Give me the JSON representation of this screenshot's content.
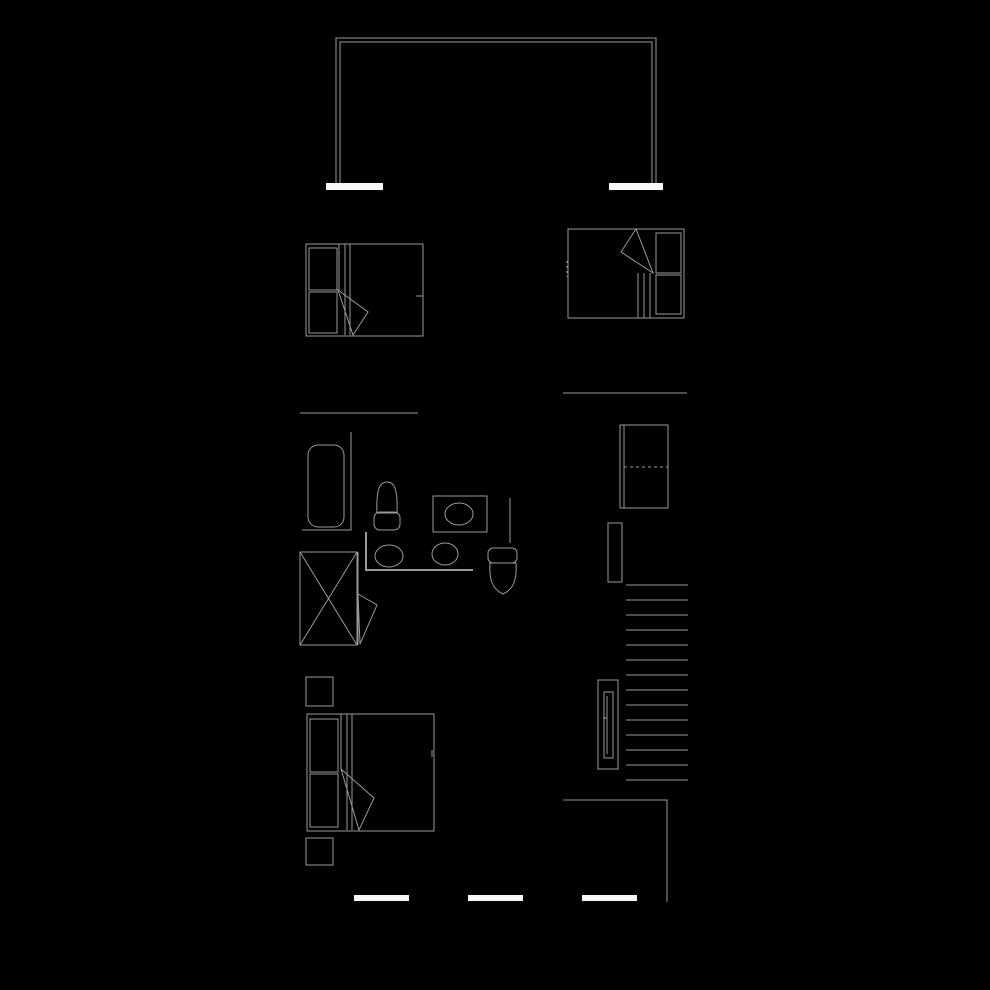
{
  "canvas": {
    "width": 990,
    "height": 990,
    "background": "#000000",
    "line_color": "#9a9a9a",
    "wall_fill": "#f7f7f7"
  },
  "floorplan": {
    "elements": [
      {
        "name": "balcony-rail-outer",
        "type": "polyline",
        "points": [
          [
            336,
            183
          ],
          [
            336,
            38
          ],
          [
            656,
            38
          ],
          [
            656,
            183
          ]
        ]
      },
      {
        "name": "balcony-rail-inner",
        "type": "polyline",
        "points": [
          [
            340,
            183
          ],
          [
            340,
            42
          ],
          [
            652,
            42
          ],
          [
            652,
            183
          ]
        ]
      },
      {
        "name": "balcony-sill-left",
        "type": "filled-rect",
        "x": 326,
        "y": 183,
        "w": 57,
        "h": 7
      },
      {
        "name": "balcony-sill-right",
        "type": "filled-rect",
        "x": 609,
        "y": 183,
        "w": 54,
        "h": 7
      },
      {
        "name": "bedroom1-bed-frame",
        "type": "rect",
        "x": 306,
        "y": 244,
        "w": 117,
        "h": 92
      },
      {
        "name": "bedroom1-pillow-1",
        "type": "rect",
        "x": 309,
        "y": 248,
        "w": 28,
        "h": 42
      },
      {
        "name": "bedroom1-pillow-2",
        "type": "rect",
        "x": 309,
        "y": 292,
        "w": 28,
        "h": 41
      },
      {
        "name": "bedroom1-sheet-line-1",
        "type": "line",
        "x1": 339,
        "y1": 244,
        "x2": 339,
        "y2": 290
      },
      {
        "name": "bedroom1-sheet-line-2",
        "type": "line",
        "x1": 345,
        "y1": 244,
        "x2": 345,
        "y2": 335
      },
      {
        "name": "bedroom1-sheet-line-3",
        "type": "line",
        "x1": 350,
        "y1": 244,
        "x2": 350,
        "y2": 335
      },
      {
        "name": "bedroom1-blanket-fold",
        "type": "polygon",
        "points": [
          [
            338,
            290
          ],
          [
            353,
            335
          ],
          [
            368,
            312
          ]
        ]
      },
      {
        "name": "bedroom1-edge-tick",
        "type": "line",
        "x1": 416,
        "y1": 296,
        "x2": 423,
        "y2": 296
      },
      {
        "name": "bedroom2-bed-frame",
        "type": "rect",
        "x": 568,
        "y": 229,
        "w": 116,
        "h": 89
      },
      {
        "name": "bedroom2-pillow-1",
        "type": "rect",
        "x": 656,
        "y": 233,
        "w": 25,
        "h": 40
      },
      {
        "name": "bedroom2-pillow-2",
        "type": "rect",
        "x": 656,
        "y": 275,
        "w": 25,
        "h": 39
      },
      {
        "name": "bedroom2-sheet-line-1",
        "type": "line",
        "x1": 638,
        "y1": 273,
        "x2": 638,
        "y2": 318
      },
      {
        "name": "bedroom2-sheet-line-2",
        "type": "line",
        "x1": 644,
        "y1": 273,
        "x2": 644,
        "y2": 318
      },
      {
        "name": "bedroom2-sheet-line-3",
        "type": "line",
        "x1": 650,
        "y1": 273,
        "x2": 650,
        "y2": 318
      },
      {
        "name": "bedroom2-blanket-fold",
        "type": "polygon",
        "points": [
          [
            636,
            229
          ],
          [
            621,
            252
          ],
          [
            653,
            273
          ]
        ]
      },
      {
        "name": "bedroom2-edge-tick",
        "type": "dashed-line",
        "x1": 567,
        "y1": 261,
        "x2": 567,
        "y2": 277,
        "dash": "2 3"
      },
      {
        "name": "partition-wall-left",
        "type": "line",
        "x1": 300,
        "y1": 413,
        "x2": 418,
        "y2": 413
      },
      {
        "name": "partition-wall-right",
        "type": "line",
        "x1": 563,
        "y1": 393,
        "x2": 687,
        "y2": 393
      },
      {
        "name": "bathtub",
        "type": "rounded-rect",
        "x": 308,
        "y": 445,
        "w": 36,
        "h": 82,
        "r": 10
      },
      {
        "name": "bathtub-wall",
        "type": "polyline",
        "points": [
          [
            351,
            432
          ],
          [
            351,
            530
          ],
          [
            302,
            530
          ]
        ]
      },
      {
        "name": "bidet-bowl",
        "type": "path",
        "d": "M377,513 C376,488 380,482 387,482 C394,482 398,488 397,513"
      },
      {
        "name": "bidet-base",
        "type": "rounded-rect",
        "x": 374,
        "y": 512,
        "w": 26,
        "h": 18,
        "r": 6
      },
      {
        "name": "bidet-base-line",
        "type": "line",
        "x1": 376,
        "y1": 513,
        "x2": 398,
        "y2": 513
      },
      {
        "name": "washer-body",
        "type": "rect",
        "x": 433,
        "y": 496,
        "w": 54,
        "h": 36
      },
      {
        "name": "washer-drum",
        "type": "ellipse",
        "cx": 459,
        "cy": 514,
        "rx": 14,
        "ry": 11
      },
      {
        "name": "wall-stub",
        "type": "line",
        "x1": 510,
        "y1": 498,
        "x2": 510,
        "y2": 543
      },
      {
        "name": "vanity-counter",
        "type": "polyline",
        "points": [
          [
            366,
            532
          ],
          [
            366,
            570
          ],
          [
            473,
            570
          ]
        ],
        "sw": 2
      },
      {
        "name": "vanity-sink-1",
        "type": "ellipse",
        "cx": 389,
        "cy": 556,
        "rx": 14,
        "ry": 11
      },
      {
        "name": "vanity-sink-2",
        "type": "ellipse",
        "cx": 445,
        "cy": 554,
        "rx": 13,
        "ry": 11
      },
      {
        "name": "toilet-tank",
        "type": "rounded-rect",
        "x": 488,
        "y": 548,
        "w": 29,
        "h": 15,
        "r": 5
      },
      {
        "name": "toilet-bowl",
        "type": "path",
        "d": "M490,563 L516,563 C517,579 514,589 503,594 C492,589 489,579 490,563 Z"
      },
      {
        "name": "shower-stall",
        "type": "rect",
        "x": 300,
        "y": 552,
        "w": 57,
        "h": 93
      },
      {
        "name": "shower-x-1",
        "type": "line",
        "x1": 300,
        "y1": 552,
        "x2": 357,
        "y2": 645
      },
      {
        "name": "shower-x-2",
        "type": "line",
        "x1": 357,
        "y1": 552,
        "x2": 300,
        "y2": 645
      },
      {
        "name": "bathroom-door-jamb",
        "type": "line",
        "x1": 358,
        "y1": 552,
        "x2": 358,
        "y2": 645
      },
      {
        "name": "bathroom-door-leaf",
        "type": "polygon",
        "points": [
          [
            358,
            594
          ],
          [
            377,
            605
          ],
          [
            360,
            644
          ]
        ]
      },
      {
        "name": "fridge-body",
        "type": "rect",
        "x": 620,
        "y": 425,
        "w": 48,
        "h": 83
      },
      {
        "name": "fridge-door-edge",
        "type": "line",
        "x1": 624,
        "y1": 425,
        "x2": 624,
        "y2": 508
      },
      {
        "name": "fridge-door-split",
        "type": "dashed-line",
        "x1": 624,
        "y1": 467,
        "x2": 668,
        "y2": 467,
        "dash": "3 3"
      },
      {
        "name": "stair-wall",
        "type": "rect",
        "x": 608,
        "y": 523,
        "w": 14,
        "h": 59
      },
      {
        "name": "stair-tread-1",
        "type": "line",
        "x1": 626,
        "y1": 585,
        "x2": 688,
        "y2": 585
      },
      {
        "name": "stair-tread-2",
        "type": "line",
        "x1": 626,
        "y1": 600,
        "x2": 688,
        "y2": 600
      },
      {
        "name": "stair-tread-3",
        "type": "line",
        "x1": 626,
        "y1": 615,
        "x2": 688,
        "y2": 615
      },
      {
        "name": "stair-tread-4",
        "type": "line",
        "x1": 626,
        "y1": 630,
        "x2": 688,
        "y2": 630
      },
      {
        "name": "stair-tread-5",
        "type": "line",
        "x1": 626,
        "y1": 645,
        "x2": 688,
        "y2": 645
      },
      {
        "name": "stair-tread-6",
        "type": "line",
        "x1": 626,
        "y1": 660,
        "x2": 688,
        "y2": 660
      },
      {
        "name": "stair-tread-7",
        "type": "line",
        "x1": 626,
        "y1": 675,
        "x2": 688,
        "y2": 675
      },
      {
        "name": "stair-tread-8",
        "type": "line",
        "x1": 626,
        "y1": 690,
        "x2": 688,
        "y2": 690
      },
      {
        "name": "stair-tread-9",
        "type": "line",
        "x1": 626,
        "y1": 705,
        "x2": 688,
        "y2": 705
      },
      {
        "name": "stair-tread-10",
        "type": "line",
        "x1": 626,
        "y1": 720,
        "x2": 688,
        "y2": 720
      },
      {
        "name": "stair-tread-11",
        "type": "line",
        "x1": 626,
        "y1": 735,
        "x2": 688,
        "y2": 735
      },
      {
        "name": "stair-tread-12",
        "type": "line",
        "x1": 626,
        "y1": 750,
        "x2": 688,
        "y2": 750
      },
      {
        "name": "stair-tread-13",
        "type": "line",
        "x1": 626,
        "y1": 765,
        "x2": 688,
        "y2": 765
      },
      {
        "name": "stair-tread-14",
        "type": "line",
        "x1": 626,
        "y1": 780,
        "x2": 688,
        "y2": 780
      },
      {
        "name": "stair-handrail-outer",
        "type": "rect",
        "x": 598,
        "y": 680,
        "w": 20,
        "h": 89
      },
      {
        "name": "stair-handrail-inner",
        "type": "rect",
        "x": 604,
        "y": 692,
        "w": 9,
        "h": 66
      },
      {
        "name": "stair-handrail-rail",
        "type": "line",
        "x1": 607,
        "y1": 696,
        "x2": 607,
        "y2": 754
      },
      {
        "name": "stair-handrail-tick",
        "type": "line",
        "x1": 603,
        "y1": 718,
        "x2": 607,
        "y2": 718
      },
      {
        "name": "lower-wall",
        "type": "polyline",
        "points": [
          [
            563,
            800
          ],
          [
            667,
            800
          ],
          [
            667,
            902
          ]
        ]
      },
      {
        "name": "bedroom3-nightstand-1",
        "type": "rect",
        "x": 306,
        "y": 677,
        "w": 27,
        "h": 29
      },
      {
        "name": "bedroom3-bed-frame",
        "type": "rect",
        "x": 307,
        "y": 714,
        "w": 127,
        "h": 117
      },
      {
        "name": "bedroom3-pillow-1",
        "type": "rect",
        "x": 310,
        "y": 719,
        "w": 28,
        "h": 53
      },
      {
        "name": "bedroom3-pillow-2",
        "type": "rect",
        "x": 310,
        "y": 774,
        "w": 28,
        "h": 53
      },
      {
        "name": "bedroom3-sheet-line-1",
        "type": "line",
        "x1": 341,
        "y1": 714,
        "x2": 341,
        "y2": 769
      },
      {
        "name": "bedroom3-sheet-line-2",
        "type": "line",
        "x1": 347,
        "y1": 714,
        "x2": 347,
        "y2": 830
      },
      {
        "name": "bedroom3-sheet-line-3",
        "type": "line",
        "x1": 352,
        "y1": 714,
        "x2": 352,
        "y2": 830
      },
      {
        "name": "bedroom3-blanket-fold",
        "type": "polygon",
        "points": [
          [
            341,
            769
          ],
          [
            359,
            830
          ],
          [
            374,
            798
          ]
        ]
      },
      {
        "name": "bedroom3-edge-tick",
        "type": "line",
        "x1": 432,
        "y1": 750,
        "x2": 432,
        "y2": 757
      },
      {
        "name": "bedroom3-nightstand-2",
        "type": "rect",
        "x": 306,
        "y": 838,
        "w": 27,
        "h": 27
      },
      {
        "name": "exterior-wall-segment-1",
        "type": "filled-rect",
        "x": 354,
        "y": 895,
        "w": 55,
        "h": 6
      },
      {
        "name": "exterior-wall-segment-2",
        "type": "filled-rect",
        "x": 468,
        "y": 895,
        "w": 55,
        "h": 6
      },
      {
        "name": "exterior-wall-segment-3",
        "type": "filled-rect",
        "x": 582,
        "y": 895,
        "w": 55,
        "h": 6
      }
    ]
  }
}
